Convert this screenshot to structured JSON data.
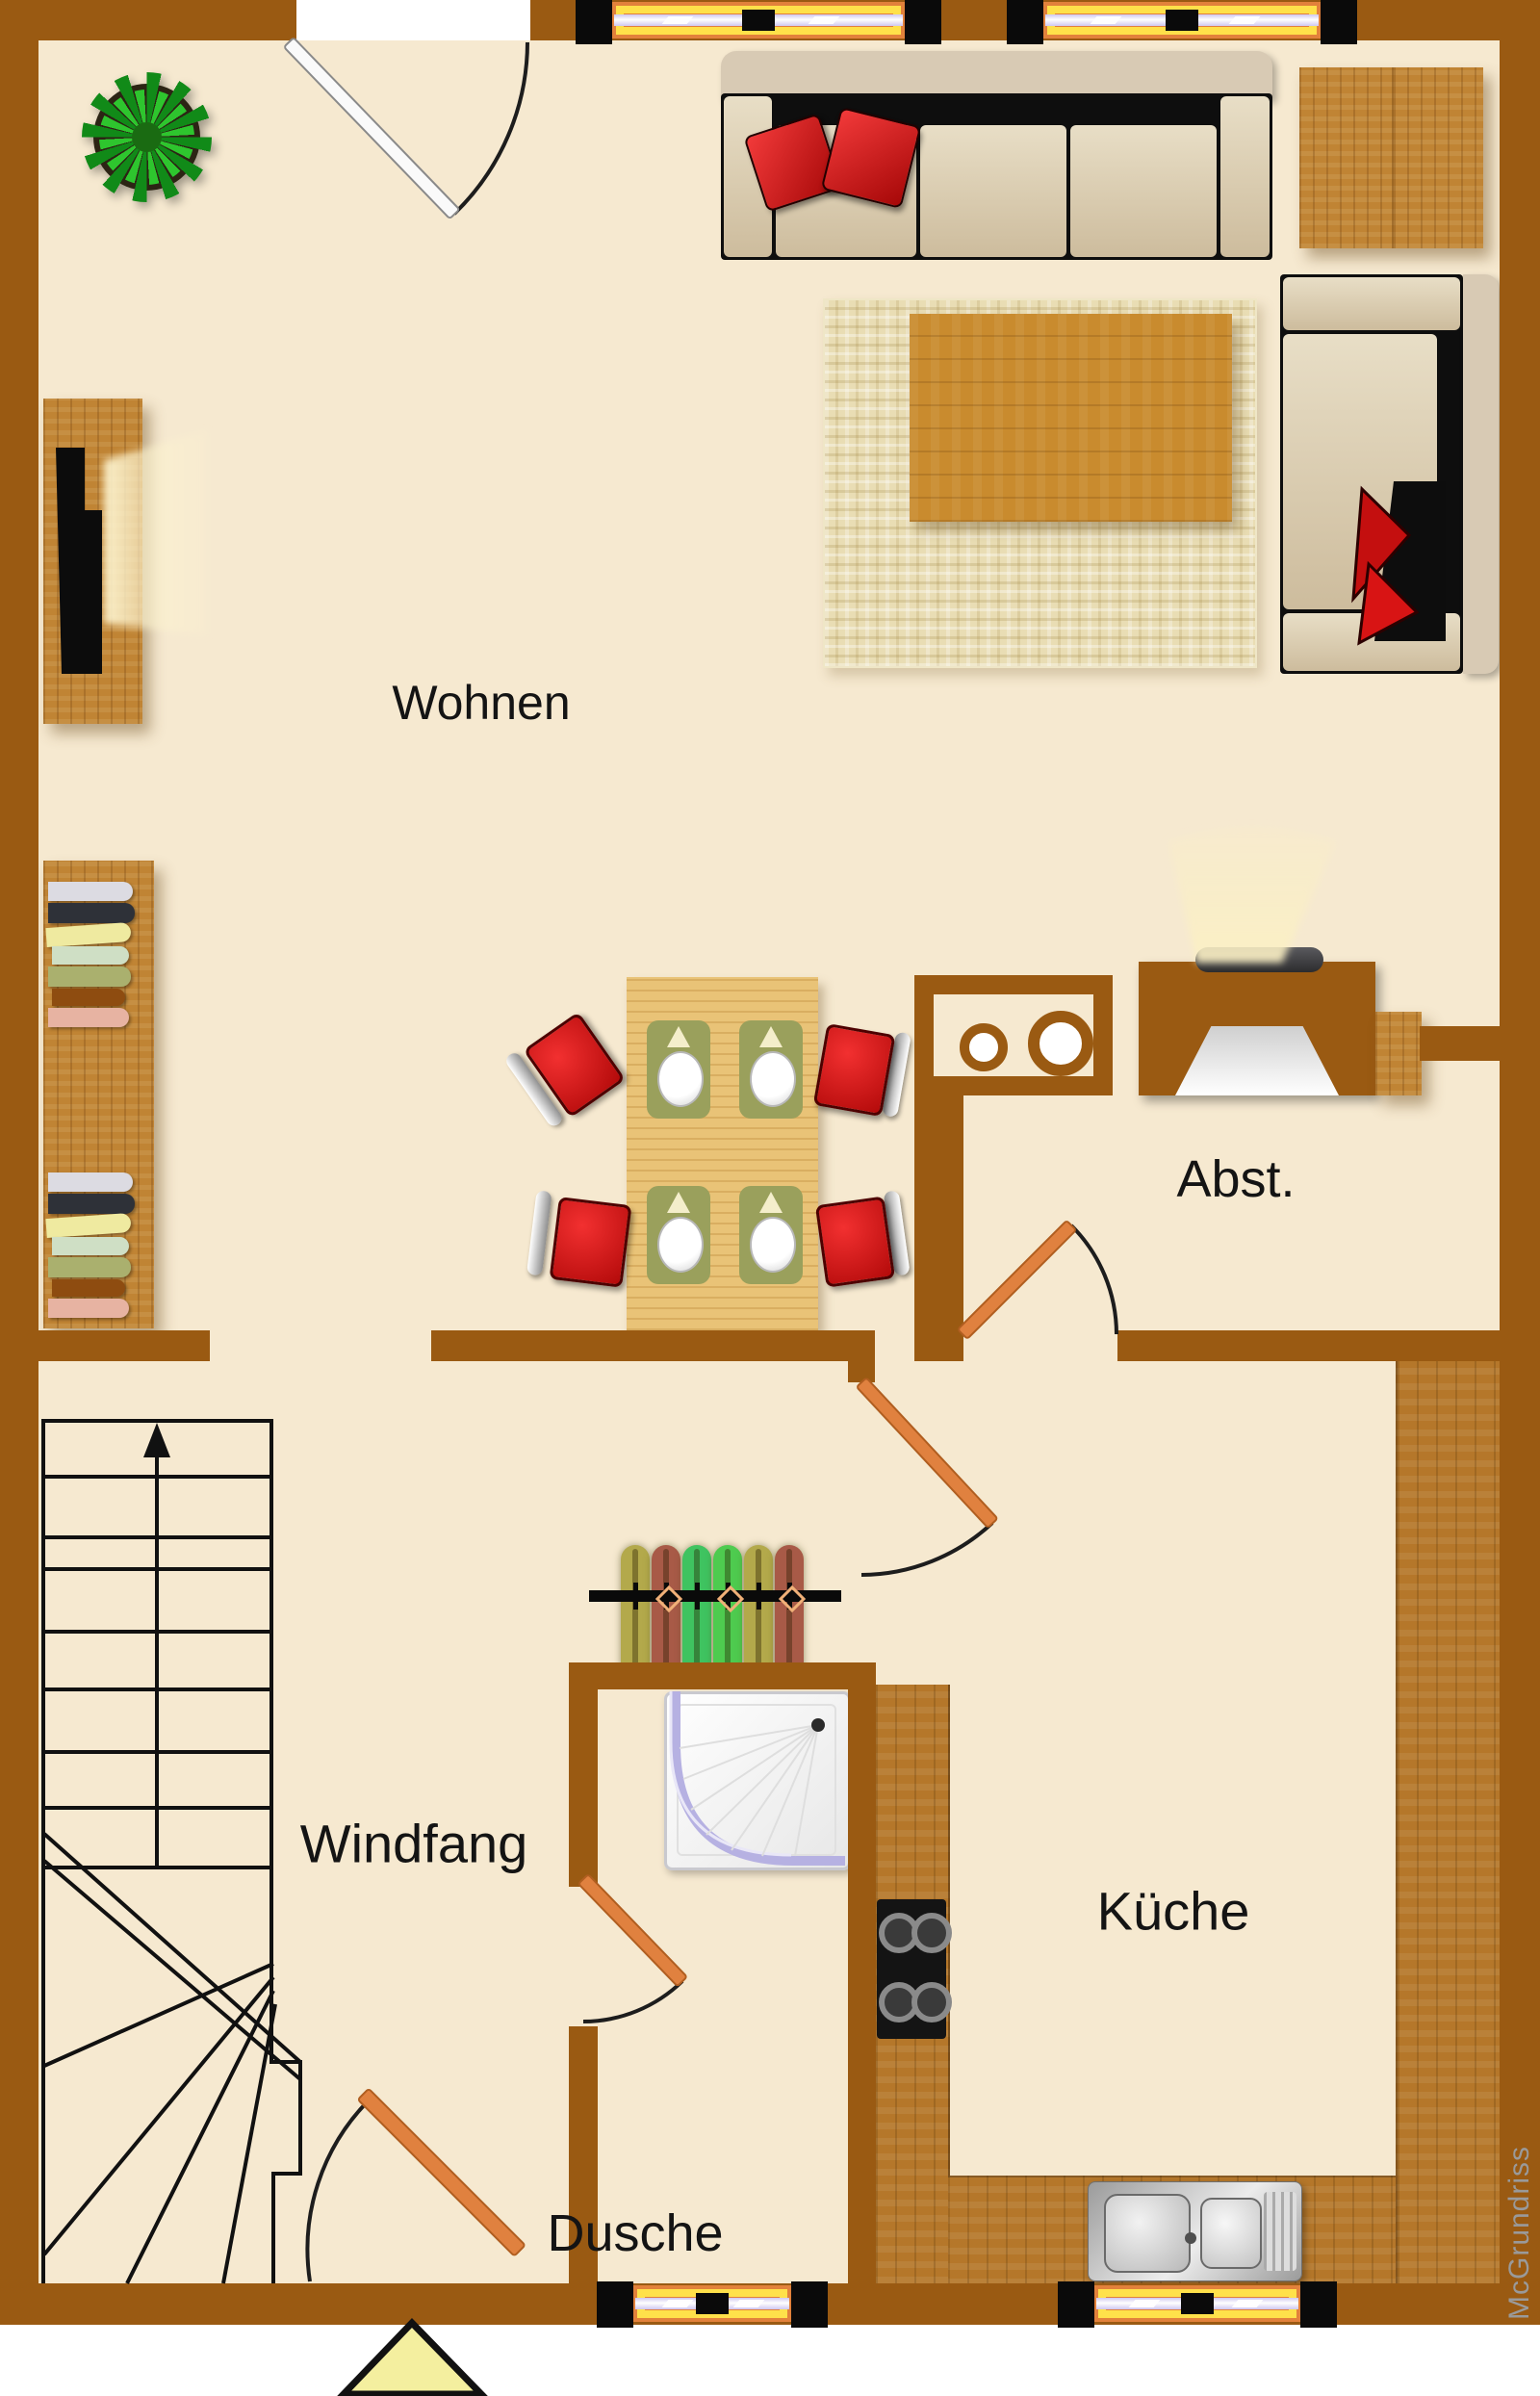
{
  "rooms": [
    {
      "id": "wohnen",
      "label": "Wohnen"
    },
    {
      "id": "abstellraum",
      "label": "Abst."
    },
    {
      "id": "windfang",
      "label": "Windfang"
    },
    {
      "id": "kueche",
      "label": "Küche"
    },
    {
      "id": "dusche",
      "label": "Dusche"
    }
  ],
  "watermark": {
    "text": "McGrundriss"
  },
  "colors": {
    "wall_brown": "#9a5a12",
    "floor_beige": "#f6e9d0",
    "counter_wood": "#b5772a",
    "door_orange": "#e0813f",
    "chair_red": "#d61212",
    "window_yellow": "#ffe14a",
    "window_orange": "#e2813b",
    "plant_green": "#2ec52e",
    "watermark_gray": "#999999"
  }
}
